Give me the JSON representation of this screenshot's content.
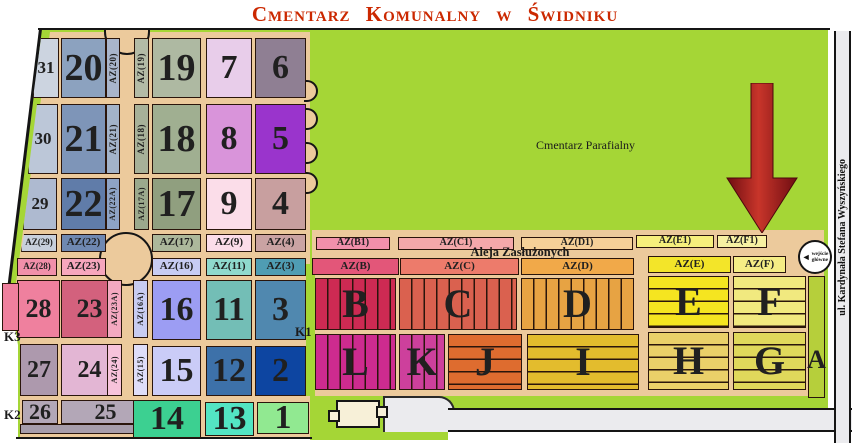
{
  "title": "Cmentarz Komunalny w Świdniku",
  "colors": {
    "green": "#a5d636",
    "tan": "#ecca9c",
    "road": "#ebebee",
    "building": "#f7f0d8",
    "title": "#cb2800",
    "arrow_dark": "#6f0d12",
    "arrow_mid": "#c8352a"
  },
  "labels": {
    "parish": "Cmentarz Parafialny",
    "aleja": "Aleja Zasłużonych",
    "street": "ul. Kardynała Stefana Wyszyńskiego",
    "entrance_line1": "wejście",
    "entrance_line2": "główne",
    "entrance_arrow": "◄",
    "gate_k1": "K1",
    "gate_k2": "K2",
    "gate_k3": "K3"
  },
  "sections": [
    {
      "n": "section-31",
      "t": "31",
      "x": 33,
      "y": 38,
      "w": 26,
      "h": 60,
      "c": "#ccd4e0",
      "fs": 17,
      "slant": 8
    },
    {
      "n": "section-20",
      "t": "20",
      "x": 61,
      "y": 38,
      "w": 45,
      "h": 60,
      "c": "#8ca2bf",
      "fs": 38
    },
    {
      "n": "strip-az20",
      "t": "AZ(20)",
      "x": 106,
      "y": 38,
      "w": 14,
      "h": 60,
      "c": "#a9b5cb",
      "fs": 9,
      "type": "v"
    },
    {
      "n": "strip-az19",
      "t": "AZ(19)",
      "x": 134,
      "y": 38,
      "w": 15,
      "h": 60,
      "c": "#b3bba6",
      "fs": 9,
      "type": "v"
    },
    {
      "n": "section-19",
      "t": "19",
      "x": 152,
      "y": 38,
      "w": 49,
      "h": 60,
      "c": "#aeb9a2",
      "fs": 38
    },
    {
      "n": "section-7",
      "t": "7",
      "x": 206,
      "y": 38,
      "w": 46,
      "h": 60,
      "c": "#e8cdea",
      "fs": 34
    },
    {
      "n": "section-6",
      "t": "6",
      "x": 255,
      "y": 38,
      "w": 51,
      "h": 60,
      "c": "#8f7f93",
      "fs": 34
    },
    {
      "n": "section-30",
      "t": "30",
      "x": 28,
      "y": 104,
      "w": 30,
      "h": 70,
      "c": "#bcc7d8",
      "fs": 17,
      "slant": 9
    },
    {
      "n": "section-21",
      "t": "21",
      "x": 61,
      "y": 104,
      "w": 45,
      "h": 70,
      "c": "#7e95b8",
      "fs": 38
    },
    {
      "n": "strip-az21",
      "t": "AZ(21)",
      "x": 106,
      "y": 104,
      "w": 14,
      "h": 70,
      "c": "#a3b3c9",
      "fs": 9,
      "type": "v"
    },
    {
      "n": "strip-az18",
      "t": "AZ(18)",
      "x": 134,
      "y": 104,
      "w": 15,
      "h": 70,
      "c": "#a7b199",
      "fs": 9,
      "type": "v"
    },
    {
      "n": "section-18",
      "t": "18",
      "x": 152,
      "y": 104,
      "w": 49,
      "h": 70,
      "c": "#a0af91",
      "fs": 38
    },
    {
      "n": "section-8",
      "t": "8",
      "x": 206,
      "y": 104,
      "w": 46,
      "h": 70,
      "c": "#d994da",
      "fs": 34
    },
    {
      "n": "section-5",
      "t": "5",
      "x": 255,
      "y": 104,
      "w": 51,
      "h": 70,
      "c": "#9a34cc",
      "fs": 34
    },
    {
      "n": "section-29",
      "t": "29",
      "x": 23,
      "y": 178,
      "w": 34,
      "h": 52,
      "c": "#aebad0",
      "fs": 17,
      "slant": 7
    },
    {
      "n": "section-22",
      "t": "22",
      "x": 61,
      "y": 178,
      "w": 45,
      "h": 52,
      "c": "#607ca9",
      "fs": 38
    },
    {
      "n": "strip-az22a",
      "t": "AZ(22A)",
      "x": 106,
      "y": 178,
      "w": 14,
      "h": 52,
      "c": "#8ea3c5",
      "fs": 8,
      "type": "v"
    },
    {
      "n": "strip-az17a",
      "t": "AZ(17A)",
      "x": 134,
      "y": 178,
      "w": 15,
      "h": 52,
      "c": "#9ba98d",
      "fs": 8,
      "type": "v"
    },
    {
      "n": "section-17",
      "t": "17",
      "x": 152,
      "y": 178,
      "w": 49,
      "h": 52,
      "c": "#909f7f",
      "fs": 38
    },
    {
      "n": "section-9",
      "t": "9",
      "x": 206,
      "y": 178,
      "w": 46,
      "h": 52,
      "c": "#fbdde9",
      "fs": 34
    },
    {
      "n": "section-4",
      "t": "4",
      "x": 255,
      "y": 178,
      "w": 51,
      "h": 52,
      "c": "#c89f9f",
      "fs": 34
    },
    {
      "n": "label-az29",
      "t": "AZ(29)",
      "x": 21,
      "y": 234,
      "w": 36,
      "h": 18,
      "c": "#c7cfdc",
      "fs": 9,
      "slant": 3
    },
    {
      "n": "label-az22",
      "t": "AZ(22)",
      "x": 61,
      "y": 234,
      "w": 45,
      "h": 18,
      "c": "#6f88b1",
      "fs": 11
    },
    {
      "n": "label-az17",
      "t": "AZ(17)",
      "x": 152,
      "y": 234,
      "w": 49,
      "h": 18,
      "c": "#acb89b",
      "fs": 11
    },
    {
      "n": "label-az9",
      "t": "AZ(9)",
      "x": 206,
      "y": 234,
      "w": 46,
      "h": 18,
      "c": "#fbdde9",
      "fs": 11
    },
    {
      "n": "label-az4",
      "t": "AZ(4)",
      "x": 255,
      "y": 234,
      "w": 51,
      "h": 18,
      "c": "#caa3a3",
      "fs": 11
    },
    {
      "n": "label-az28",
      "t": "AZ(28)",
      "x": 17,
      "y": 258,
      "w": 40,
      "h": 18,
      "c": "#f190aa",
      "fs": 9
    },
    {
      "n": "label-az23",
      "t": "AZ(23)",
      "x": 61,
      "y": 258,
      "w": 45,
      "h": 18,
      "c": "#f6a6bd",
      "fs": 11
    },
    {
      "n": "label-az16",
      "t": "AZ(16)",
      "x": 152,
      "y": 258,
      "w": 49,
      "h": 18,
      "c": "#c7ccf3",
      "fs": 11
    },
    {
      "n": "label-az11",
      "t": "AZ(11)",
      "x": 206,
      "y": 258,
      "w": 46,
      "h": 18,
      "c": "#8fd9cd",
      "fs": 11
    },
    {
      "n": "label-az3",
      "t": "AZ(3)",
      "x": 255,
      "y": 258,
      "w": 51,
      "h": 18,
      "c": "#4f9db3",
      "fs": 11
    },
    {
      "n": "section-28",
      "t": "28",
      "x": 17,
      "y": 280,
      "w": 43,
      "h": 58,
      "c": "#ef809e",
      "fs": 26
    },
    {
      "n": "section-28-annex",
      "t": "",
      "x": 2,
      "y": 283,
      "w": 17,
      "h": 48,
      "c": "#ef809e",
      "fs": 10
    },
    {
      "n": "section-23",
      "t": "23",
      "x": 61,
      "y": 280,
      "w": 57,
      "h": 58,
      "c": "#d3617d",
      "fs": 26
    },
    {
      "n": "strip-az23a",
      "t": "AZ(23A)",
      "x": 107,
      "y": 280,
      "w": 15,
      "h": 58,
      "c": "#f4a9c1",
      "fs": 8,
      "type": "v"
    },
    {
      "n": "strip-az16a",
      "t": "AZ(16A)",
      "x": 133,
      "y": 280,
      "w": 15,
      "h": 58,
      "c": "#c8ccf1",
      "fs": 8,
      "type": "v"
    },
    {
      "n": "section-16",
      "t": "16",
      "x": 152,
      "y": 280,
      "w": 49,
      "h": 60,
      "c": "#9c9df3",
      "fs": 34
    },
    {
      "n": "section-11",
      "t": "11",
      "x": 206,
      "y": 280,
      "w": 46,
      "h": 60,
      "c": "#73beb6",
      "fs": 34
    },
    {
      "n": "section-3",
      "t": "3",
      "x": 255,
      "y": 280,
      "w": 51,
      "h": 60,
      "c": "#5088af",
      "fs": 34
    },
    {
      "n": "section-27",
      "t": "27",
      "x": 20,
      "y": 344,
      "w": 38,
      "h": 52,
      "c": "#ad99ad",
      "fs": 24
    },
    {
      "n": "section-24",
      "t": "24",
      "x": 61,
      "y": 344,
      "w": 57,
      "h": 52,
      "c": "#e3b6d4",
      "fs": 24
    },
    {
      "n": "strip-az24",
      "t": "AZ(24)",
      "x": 107,
      "y": 344,
      "w": 15,
      "h": 52,
      "c": "#f7c3db",
      "fs": 8,
      "type": "v"
    },
    {
      "n": "strip-az15",
      "t": "AZ(15)",
      "x": 133,
      "y": 344,
      "w": 15,
      "h": 52,
      "c": "#deddf9",
      "fs": 8,
      "type": "v"
    },
    {
      "n": "section-15",
      "t": "15",
      "x": 152,
      "y": 346,
      "w": 49,
      "h": 50,
      "c": "#caccf7",
      "fs": 34
    },
    {
      "n": "section-12",
      "t": "12",
      "x": 206,
      "y": 346,
      "w": 46,
      "h": 50,
      "c": "#3d71a9",
      "fs": 34
    },
    {
      "n": "section-2",
      "t": "2",
      "x": 255,
      "y": 346,
      "w": 51,
      "h": 50,
      "c": "#0d45a1",
      "fs": 34
    },
    {
      "n": "section-26",
      "t": "26",
      "x": 22,
      "y": 400,
      "w": 36,
      "h": 24,
      "c": "#b3a7b7",
      "fs": 22
    },
    {
      "n": "section-25",
      "t": "25",
      "x": 61,
      "y": 400,
      "w": 89,
      "h": 24,
      "c": "#b3a7b7",
      "fs": 22
    },
    {
      "n": "edge-strip-2625",
      "t": "",
      "x": 20,
      "y": 424,
      "w": 130,
      "h": 10,
      "c": "#a79dab",
      "fs": 10
    },
    {
      "n": "section-14",
      "t": "14",
      "x": 133,
      "y": 400,
      "w": 68,
      "h": 38,
      "c": "#3cd091",
      "fs": 34
    },
    {
      "n": "section-13",
      "t": "13",
      "x": 205,
      "y": 402,
      "w": 49,
      "h": 34,
      "c": "#53e5c3",
      "fs": 34
    },
    {
      "n": "section-1",
      "t": "1",
      "x": 257,
      "y": 402,
      "w": 52,
      "h": 32,
      "c": "#91e991",
      "fs": 34
    },
    {
      "n": "label-azb1",
      "t": "AZ(B1)",
      "x": 316,
      "y": 237,
      "w": 74,
      "h": 13,
      "c": "#f190ab",
      "fs": 10
    },
    {
      "n": "label-azc1",
      "t": "AZ(C1)",
      "x": 398,
      "y": 237,
      "w": 116,
      "h": 13,
      "c": "#f4a8aa",
      "fs": 10
    },
    {
      "n": "label-azd1",
      "t": "AZ(D1)",
      "x": 521,
      "y": 237,
      "w": 112,
      "h": 13,
      "c": "#f6d098",
      "fs": 10
    },
    {
      "n": "label-aze1",
      "t": "AZ(E1)",
      "x": 636,
      "y": 235,
      "w": 78,
      "h": 13,
      "c": "#f6ef7c",
      "fs": 10
    },
    {
      "n": "label-azf1",
      "t": "AZ(F1)",
      "x": 717,
      "y": 235,
      "w": 50,
      "h": 13,
      "c": "#f7f1a2",
      "fs": 10
    },
    {
      "n": "label-azb",
      "t": "AZ(B)",
      "x": 312,
      "y": 258,
      "w": 87,
      "h": 17,
      "c": "#e35679",
      "fs": 11
    },
    {
      "n": "label-azc",
      "t": "AZ(C)",
      "x": 400,
      "y": 258,
      "w": 119,
      "h": 17,
      "c": "#ed7b6b",
      "fs": 11
    },
    {
      "n": "label-azd",
      "t": "AZ(D)",
      "x": 521,
      "y": 258,
      "w": 113,
      "h": 17,
      "c": "#f1a949",
      "fs": 11
    },
    {
      "n": "label-aze",
      "t": "AZ(E)",
      "x": 648,
      "y": 256,
      "w": 83,
      "h": 17,
      "c": "#f3e529",
      "fs": 11
    },
    {
      "n": "label-azf",
      "t": "AZ(F)",
      "x": 733,
      "y": 256,
      "w": 53,
      "h": 17,
      "c": "#f5ed85",
      "fs": 11
    },
    {
      "n": "section-b",
      "t": "B",
      "x": 315,
      "y": 278,
      "w": 81,
      "h": 52,
      "c": "#cd2a53",
      "fs": 40,
      "type": "vs"
    },
    {
      "n": "section-c",
      "t": "C",
      "x": 399,
      "y": 278,
      "w": 118,
      "h": 52,
      "c": "#da614f",
      "fs": 40,
      "type": "vs"
    },
    {
      "n": "section-d",
      "t": "D",
      "x": 521,
      "y": 278,
      "w": 113,
      "h": 52,
      "c": "#e7a343",
      "fs": 40,
      "type": "vs"
    },
    {
      "n": "section-e",
      "t": "E",
      "x": 648,
      "y": 276,
      "w": 81,
      "h": 52,
      "c": "#f5e520",
      "fs": 40,
      "type": "hs"
    },
    {
      "n": "section-f",
      "t": "F",
      "x": 733,
      "y": 276,
      "w": 73,
      "h": 52,
      "c": "#f1e97f",
      "fs": 40,
      "type": "hs"
    },
    {
      "n": "section-l",
      "t": "L",
      "x": 315,
      "y": 334,
      "w": 81,
      "h": 56,
      "c": "#cd2b8f",
      "fs": 40,
      "type": "vs"
    },
    {
      "n": "section-k",
      "t": "K",
      "x": 399,
      "y": 334,
      "w": 46,
      "h": 56,
      "c": "#cd409c",
      "fs": 40,
      "type": "vs"
    },
    {
      "n": "section-j",
      "t": "J",
      "x": 448,
      "y": 334,
      "w": 74,
      "h": 56,
      "c": "#de6c2f",
      "fs": 40,
      "type": "hs"
    },
    {
      "n": "section-i",
      "t": "I",
      "x": 527,
      "y": 334,
      "w": 112,
      "h": 56,
      "c": "#e3bc2d",
      "fs": 40,
      "type": "hs"
    },
    {
      "n": "section-h",
      "t": "H",
      "x": 648,
      "y": 332,
      "w": 81,
      "h": 58,
      "c": "#ead069",
      "fs": 40,
      "type": "hs"
    },
    {
      "n": "section-g",
      "t": "G",
      "x": 733,
      "y": 332,
      "w": 73,
      "h": 58,
      "c": "#e0d85b",
      "fs": 40,
      "type": "hs"
    },
    {
      "n": "section-a",
      "t": "A",
      "x": 808,
      "y": 276,
      "w": 17,
      "h": 122,
      "c": "#b6cf3b",
      "fs": 26,
      "bottom": true
    }
  ]
}
